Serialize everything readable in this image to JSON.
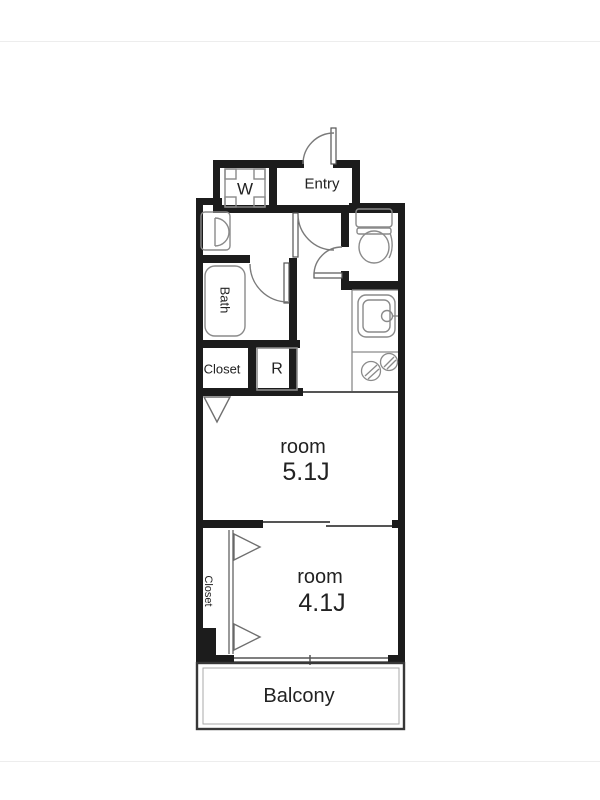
{
  "page": {
    "background": "#ffffff"
  },
  "floorplan": {
    "labels": {
      "washer": "W",
      "entry": "Entry",
      "bath": "Bath",
      "closet_upper": "Closet",
      "refrigerator": "R",
      "room1_name": "room",
      "room1_size": "5.1J",
      "room2_name": "room",
      "room2_size": "4.1J",
      "closet_lower": "Closet",
      "balcony": "Balcony"
    },
    "colors": {
      "wall": "#1c1c1c",
      "line": "#555555",
      "fixture": "#8a8a8a",
      "text": "#222222"
    }
  }
}
